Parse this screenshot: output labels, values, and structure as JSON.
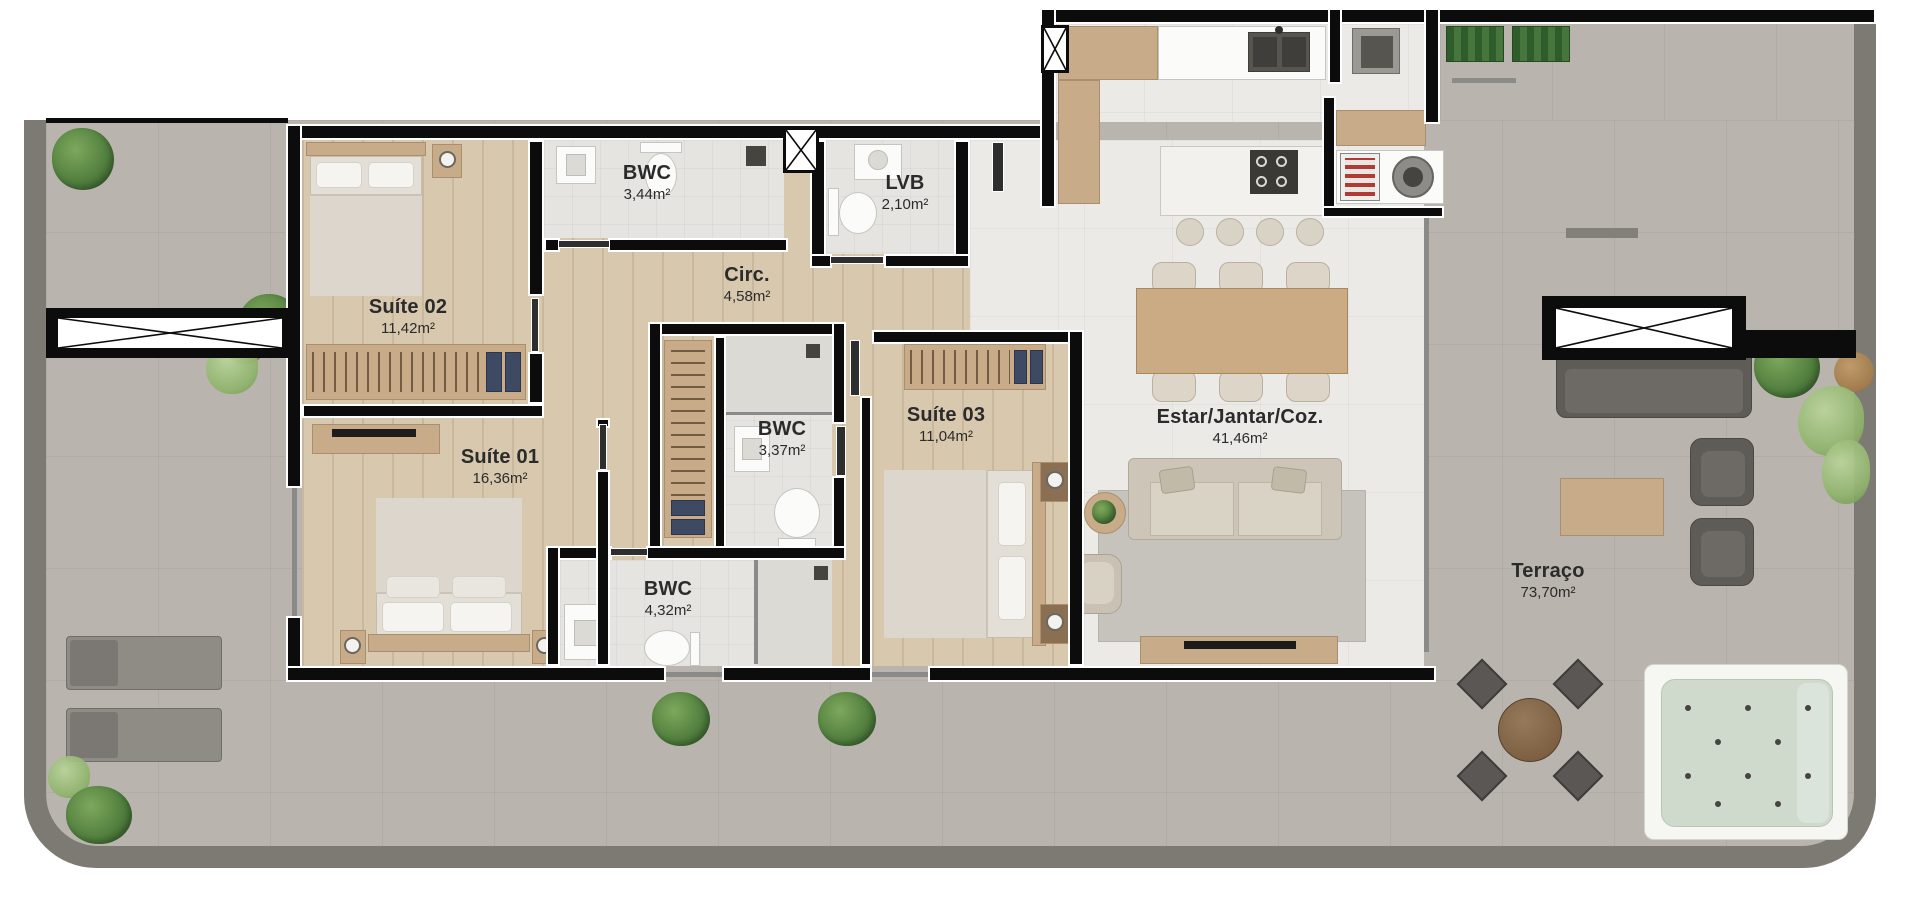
{
  "plan": {
    "type": "residential-floor-plan",
    "rooms": [
      {
        "id": "suite-02",
        "name": "Suíte 02",
        "area": "11,42m²"
      },
      {
        "id": "bwc-1",
        "name": "BWC",
        "area": "3,44m²"
      },
      {
        "id": "lvb",
        "name": "LVB",
        "area": "2,10m²"
      },
      {
        "id": "circ",
        "name": "Circ.",
        "area": "4,58m²"
      },
      {
        "id": "suite-01",
        "name": "Suíte 01",
        "area": "16,36m²"
      },
      {
        "id": "bwc-2",
        "name": "BWC",
        "area": "3,37m²"
      },
      {
        "id": "suite-03",
        "name": "Suíte 03",
        "area": "11,04m²"
      },
      {
        "id": "bwc-3",
        "name": "BWC",
        "area": "4,32m²"
      },
      {
        "id": "estar",
        "name": "Estar/Jantar/Coz.",
        "area": "41,46m²"
      },
      {
        "id": "terraco",
        "name": "Terraço",
        "area": "73,70m²"
      }
    ],
    "colors": {
      "wall": "#0c0c0c",
      "wood_floor": "#d8c8ae",
      "tile_floor": "#eceae6",
      "terrace": "#b9b5ae",
      "terrace_border": "#7d7973",
      "jacuzzi_water": "#cfdacc",
      "plant_green": "#4e7c3c",
      "label_text": "#2b2b2b"
    }
  }
}
